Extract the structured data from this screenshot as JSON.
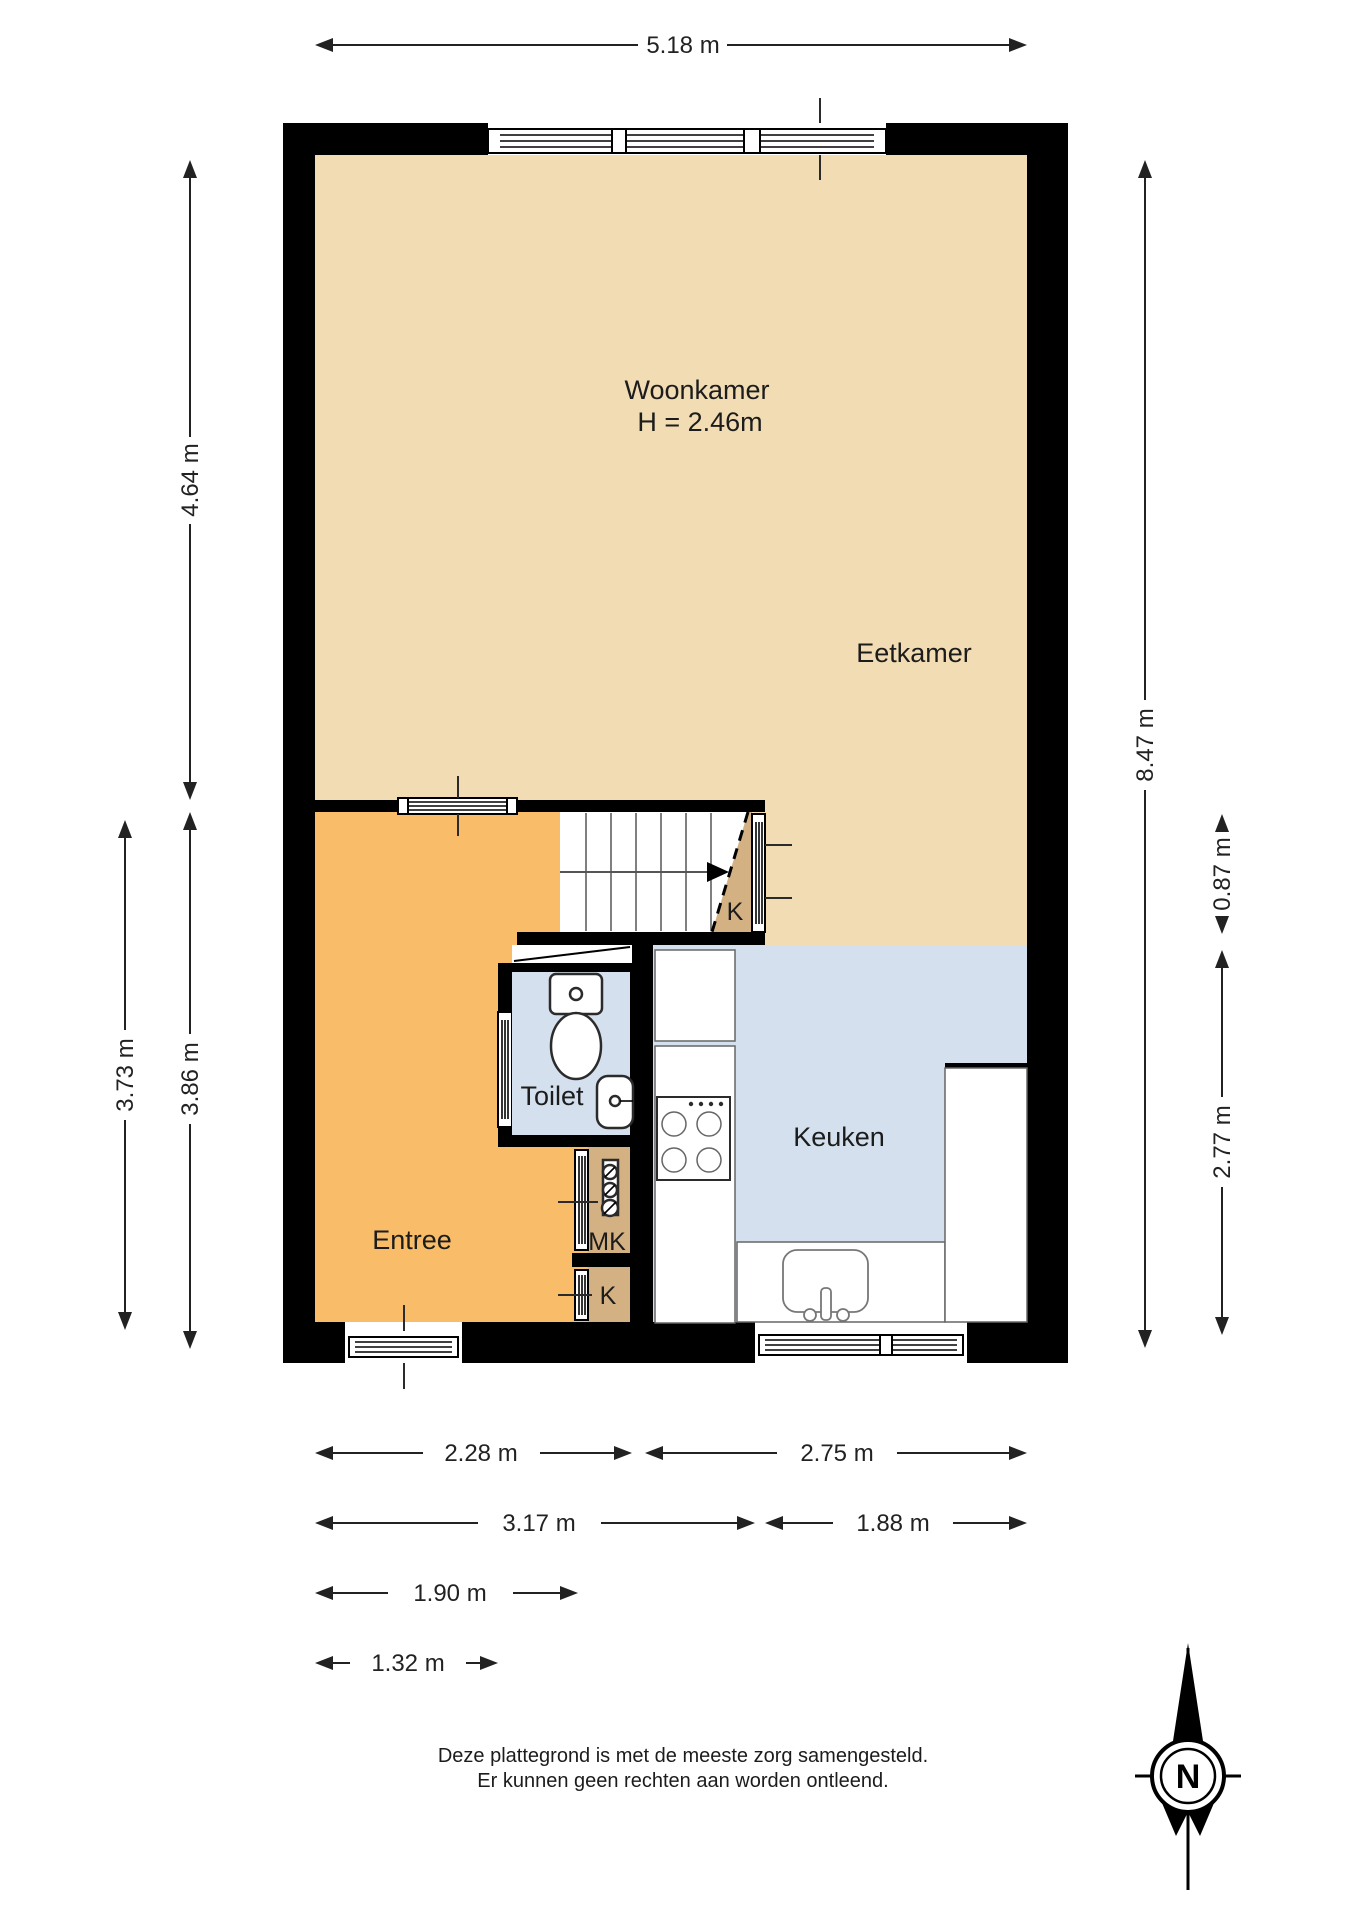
{
  "colors": {
    "floor_living": "#F2DCB4",
    "floor_hall": "#F9BD69",
    "floor_kitchen": "#D4E0ED",
    "floor_closet": "#D3B183",
    "wall": "#000000",
    "dim_color": "#222222"
  },
  "rooms": {
    "woonkamer": {
      "label": "Woonkamer",
      "height_note": "H = 2.46m"
    },
    "eetkamer": {
      "label": "Eetkamer"
    },
    "entree": {
      "label": "Entree"
    },
    "toilet": {
      "label": "Toilet"
    },
    "keuken": {
      "label": "Keuken"
    },
    "meterkast": {
      "label": "MK"
    },
    "kast_hal": {
      "label": "K"
    },
    "kast_trap": {
      "label": "K"
    }
  },
  "dimensions": {
    "top_width": "5.18 m",
    "left_upper": "4.64 m",
    "left_lower_outer": "3.73 m",
    "left_lower_inner": "3.86 m",
    "right_full": "8.47 m",
    "right_stairs": "0.87 m",
    "right_kitchen": "2.77 m",
    "bottom_row1_left": "2.28 m",
    "bottom_row1_right": "2.75 m",
    "bottom_row2_left": "3.17 m",
    "bottom_row2_right": "1.88 m",
    "bottom_row3": "1.90 m",
    "bottom_row4": "1.32 m"
  },
  "disclaimer": {
    "line1": "Deze plattegrond is met de meeste zorg samengesteld.",
    "line2": "Er kunnen geen rechten aan worden ontleend."
  },
  "compass": {
    "north_label": "N"
  }
}
